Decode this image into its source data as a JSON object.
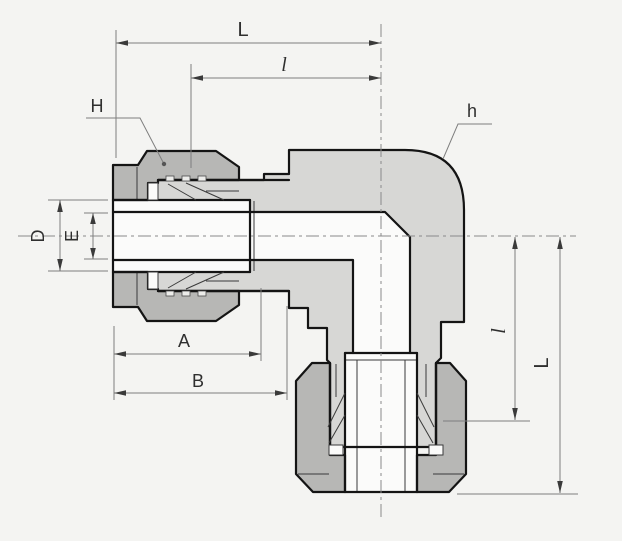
{
  "drawing": {
    "kind": "tube-fitting-union-elbow-cross-section",
    "labels": {
      "L_top": "L",
      "l_top": "l",
      "H": "H",
      "h": "h",
      "D": "D",
      "E": "E",
      "A": "A",
      "B": "B",
      "l_right": "l",
      "L_right": "L"
    },
    "colors": {
      "background": "#f4f4f2",
      "body_fill": "#d7d7d5",
      "nut_fill": "#b7b7b5",
      "bore_fill": "#fbfbfa",
      "outline": "#141414",
      "dimension_line": "#7e7e7e",
      "label_text": "#2f2f2f"
    }
  }
}
